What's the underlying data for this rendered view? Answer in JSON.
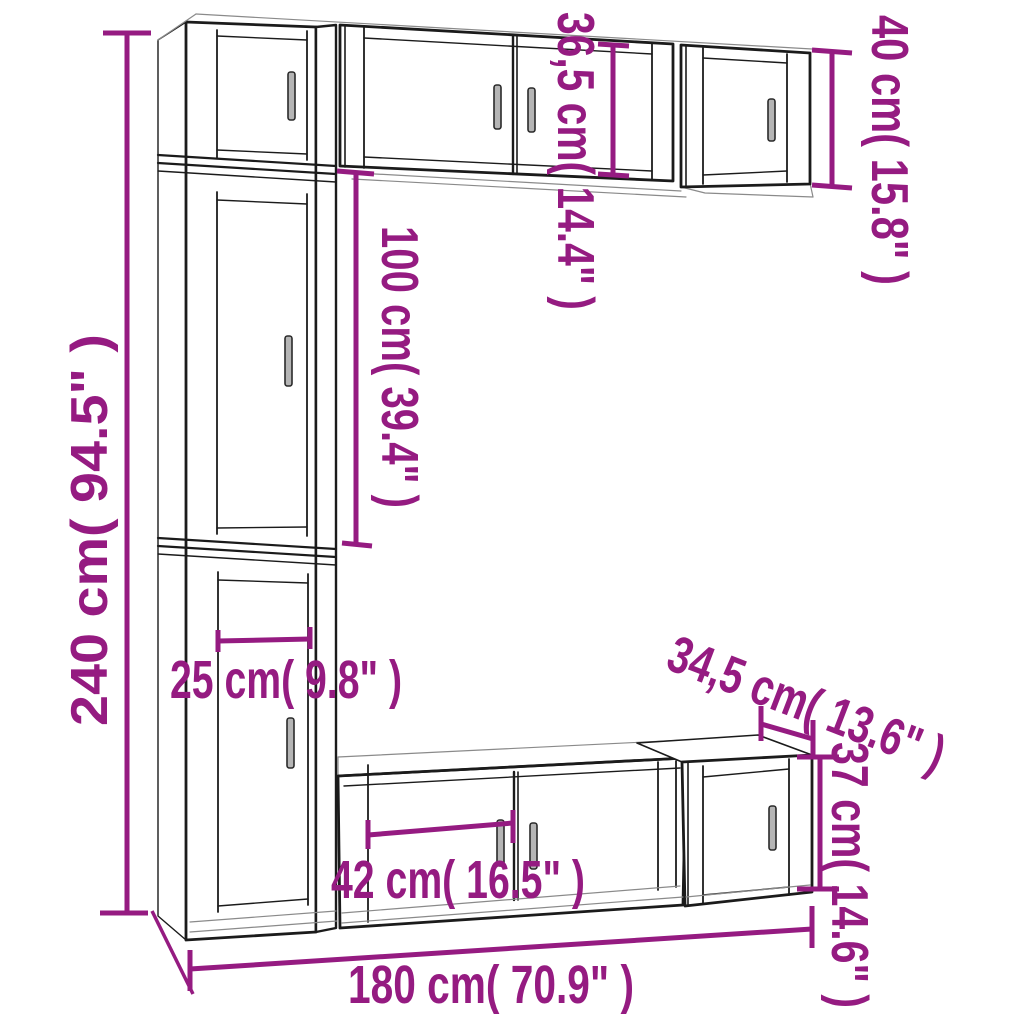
{
  "diagram": {
    "type": "furniture-dimension-drawing",
    "subject": "7-piece TV wall cabinet set, perspective line drawing with dimension callouts",
    "colors": {
      "dimension_accent": "#951B81",
      "outline": "#1B1B1B",
      "thin_line": "#8A8A8A",
      "background": "#FFFFFF"
    },
    "units": "cm (inches)"
  },
  "dims": {
    "d240": {
      "label": "240 cm( 94.5\" )",
      "meaning": "total height of tall left column"
    },
    "d100": {
      "label": "100 cm( 39.4\" )",
      "meaning": "height of middle tall cabinet"
    },
    "d365": {
      "label": "36,5 cm( 14.4\" )",
      "meaning": "height of top middle wall cabinet"
    },
    "d40": {
      "label": "40 cm( 15.8\" )",
      "meaning": "height of top right wall cabinet"
    },
    "d25": {
      "label": "25 cm( 9.8\" )",
      "meaning": "door width of tall cabinet"
    },
    "d42": {
      "label": "42 cm( 16.5\" )",
      "meaning": "door width of TV bench"
    },
    "d345": {
      "label": "34,5 cm( 13.6\" )",
      "meaning": "depth of right bottom cabinet"
    },
    "d37": {
      "label": "37 cm( 14.6\" )",
      "meaning": "height of right bottom cabinet"
    },
    "d180": {
      "label": "180 cm( 70.9\" )",
      "meaning": "total width"
    }
  }
}
